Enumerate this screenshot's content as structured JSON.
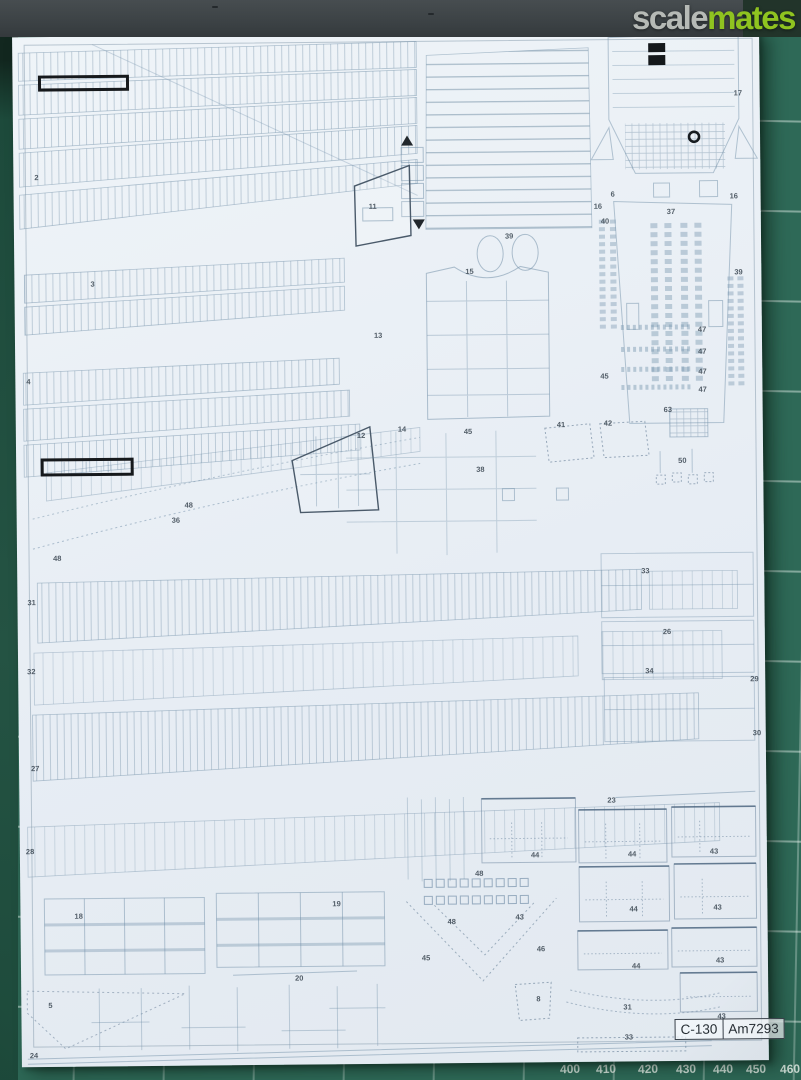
{
  "theme": {
    "mat_green": "#2e6957",
    "mat_green_dark": "#1d4a3b",
    "sheet_color": "#e9eff5",
    "logo_scale_color": "#b6bab6",
    "logo_mates_color": "#8fc320",
    "label_ink": "#3e4a55"
  },
  "watermark": {
    "left": "scale",
    "right": "mates"
  },
  "title_block": {
    "model": "C-130",
    "code": "Am7293"
  },
  "mat_ruler": {
    "numbers": [
      {
        "t": "400",
        "x": 560
      },
      {
        "t": "410",
        "x": 596
      },
      {
        "t": "420",
        "x": 638
      },
      {
        "t": "430",
        "x": 676
      },
      {
        "t": "440",
        "x": 713
      },
      {
        "t": "450",
        "x": 746
      },
      {
        "t": "460",
        "x": 780
      }
    ]
  },
  "parts_sheet": {
    "labels": [
      {
        "t": "2",
        "x": 21,
        "y": 137
      },
      {
        "t": "3",
        "x": 76,
        "y": 244
      },
      {
        "t": "4",
        "x": 11,
        "y": 341
      },
      {
        "t": "11",
        "x": 355,
        "y": 169
      },
      {
        "t": "13",
        "x": 359,
        "y": 298
      },
      {
        "t": "15",
        "x": 451,
        "y": 235
      },
      {
        "t": "39",
        "x": 491,
        "y": 200
      },
      {
        "t": "12",
        "x": 341,
        "y": 398
      },
      {
        "t": "14",
        "x": 382,
        "y": 392
      },
      {
        "t": "45",
        "x": 448,
        "y": 395
      },
      {
        "t": "41",
        "x": 541,
        "y": 389
      },
      {
        "t": "42",
        "x": 588,
        "y": 388
      },
      {
        "t": "38",
        "x": 460,
        "y": 433
      },
      {
        "t": "6",
        "x": 597,
        "y": 159
      },
      {
        "t": "16",
        "x": 580,
        "y": 171
      },
      {
        "t": "40",
        "x": 587,
        "y": 186
      },
      {
        "t": "37",
        "x": 653,
        "y": 177
      },
      {
        "t": "16",
        "x": 716,
        "y": 162
      },
      {
        "t": "17",
        "x": 721,
        "y": 59
      },
      {
        "t": "39",
        "x": 720,
        "y": 238
      },
      {
        "t": "47",
        "x": 683,
        "y": 295
      },
      {
        "t": "47",
        "x": 683,
        "y": 317
      },
      {
        "t": "47",
        "x": 683,
        "y": 337
      },
      {
        "t": "47",
        "x": 683,
        "y": 355
      },
      {
        "t": "45",
        "x": 585,
        "y": 341
      },
      {
        "t": "63",
        "x": 648,
        "y": 375
      },
      {
        "t": "50",
        "x": 662,
        "y": 426
      },
      {
        "t": "48",
        "x": 168,
        "y": 466
      },
      {
        "t": "36",
        "x": 155,
        "y": 481
      },
      {
        "t": "48",
        "x": 36,
        "y": 518
      },
      {
        "t": "33",
        "x": 624,
        "y": 536
      },
      {
        "t": "26",
        "x": 645,
        "y": 597
      },
      {
        "t": "34",
        "x": 627,
        "y": 636
      },
      {
        "t": "29",
        "x": 732,
        "y": 645
      },
      {
        "t": "30",
        "x": 734,
        "y": 699
      },
      {
        "t": "31",
        "x": 10,
        "y": 562
      },
      {
        "t": "32",
        "x": 9,
        "y": 631
      },
      {
        "t": "27",
        "x": 12,
        "y": 728
      },
      {
        "t": "28",
        "x": 6,
        "y": 811
      },
      {
        "t": "23",
        "x": 588,
        "y": 765
      },
      {
        "t": "18",
        "x": 54,
        "y": 876
      },
      {
        "t": "19",
        "x": 312,
        "y": 866
      },
      {
        "t": "20",
        "x": 274,
        "y": 940
      },
      {
        "t": "5",
        "x": 27,
        "y": 965
      },
      {
        "t": "24",
        "x": 8,
        "y": 1015
      },
      {
        "t": "44",
        "x": 511,
        "y": 819
      },
      {
        "t": "48",
        "x": 455,
        "y": 837
      },
      {
        "t": "48",
        "x": 427,
        "y": 885
      },
      {
        "t": "43",
        "x": 495,
        "y": 881
      },
      {
        "t": "45",
        "x": 401,
        "y": 921
      },
      {
        "t": "46",
        "x": 516,
        "y": 913
      },
      {
        "t": "8",
        "x": 515,
        "y": 963
      },
      {
        "t": "44",
        "x": 608,
        "y": 819
      },
      {
        "t": "43",
        "x": 690,
        "y": 817
      },
      {
        "t": "44",
        "x": 609,
        "y": 874
      },
      {
        "t": "43",
        "x": 693,
        "y": 873
      },
      {
        "t": "44",
        "x": 611,
        "y": 931
      },
      {
        "t": "43",
        "x": 695,
        "y": 926
      },
      {
        "t": "31",
        "x": 602,
        "y": 972
      },
      {
        "t": "43",
        "x": 696,
        "y": 982
      },
      {
        "t": "33",
        "x": 603,
        "y": 1002
      }
    ]
  }
}
